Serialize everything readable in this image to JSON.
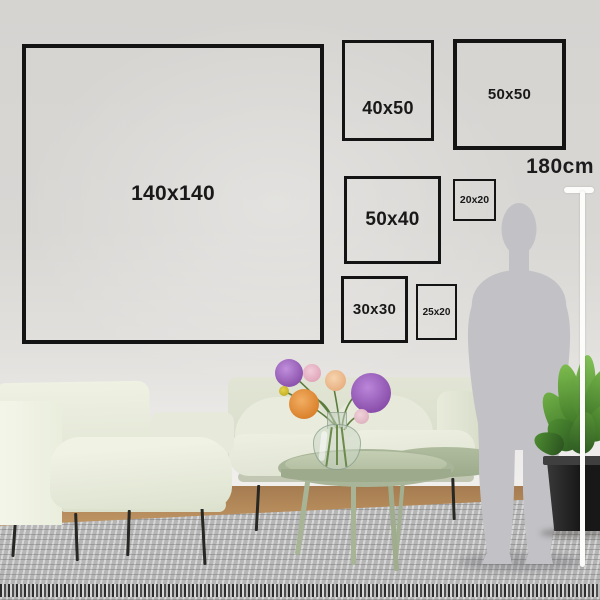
{
  "size_guide": {
    "frames": [
      {
        "id": "140x140",
        "label": "140x140"
      },
      {
        "id": "40x50",
        "label": "40x50"
      },
      {
        "id": "50x50",
        "label": "50x50"
      },
      {
        "id": "50x40",
        "label": "50x40"
      },
      {
        "id": "20x20",
        "label": "20x20"
      },
      {
        "id": "30x30",
        "label": "30x30"
      },
      {
        "id": "25x20",
        "label": "25x20"
      }
    ],
    "height_marker": {
      "label": "180cm"
    }
  },
  "colors": {
    "wall": "#d8d6d3",
    "frame_border": "#141414",
    "label_text": "#191919",
    "marker_line": "#fcfcfb",
    "silhouette": "#c2c2c6",
    "sofa": "#e4e8d7",
    "coffee_table": "#aeb99c",
    "rug": "#b6b6b6",
    "wood_floor": "#bd9261",
    "plant_pot": "#1f1f1f",
    "flower_purple": "#9a63bd",
    "flower_orange": "#e28f3f"
  },
  "scene": {
    "objects": [
      "person-silhouette",
      "sofa",
      "armchair",
      "coffee-tables",
      "vase-with-flowers",
      "potted-plant",
      "area-rug",
      "wood-floor"
    ]
  }
}
